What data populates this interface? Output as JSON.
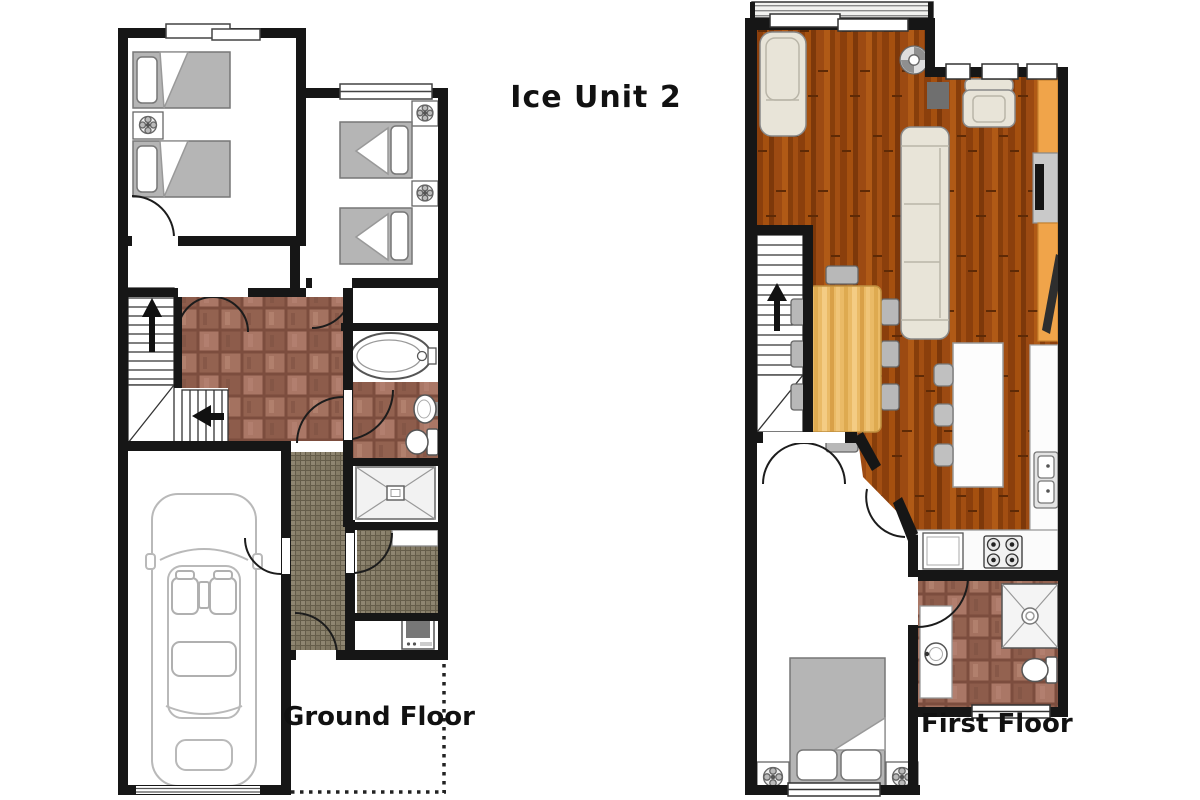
{
  "title": "Ice Unit 2",
  "floors": {
    "ground": {
      "label": "Ground Floor",
      "rooms": [
        "bedroom-1",
        "bedroom-2",
        "bathroom",
        "hallway",
        "stairs",
        "entry-hall",
        "shower-room",
        "utility-room",
        "garage"
      ],
      "features": [
        "twin-bed",
        "twin-bed",
        "twin-bed",
        "twin-bed",
        "nightstand-fan",
        "bathtub",
        "wash-basin",
        "toilet",
        "shower",
        "washing-machine",
        "car"
      ]
    },
    "first": {
      "label": "First Floor",
      "rooms": [
        "balcony",
        "living-room",
        "dining-area",
        "kitchen",
        "stairs",
        "bedroom",
        "bathroom"
      ],
      "features": [
        "chaise-longue",
        "sofa",
        "armchair",
        "tv-unit",
        "ceiling-fan",
        "dining-table",
        "dining-chairs",
        "kitchen-island",
        "bar-stools",
        "double-sink",
        "stove",
        "double-bed",
        "nightstand-fan",
        "shower",
        "toilet",
        "wash-basin"
      ]
    }
  },
  "colors": {
    "wall": "#161616",
    "wood_floor": "#96470f",
    "brick_tile": "#9c6a58",
    "mosaic_tile": "#867d67",
    "table_wood": "#eaba66",
    "counter_orange": "#f0a44a",
    "bed_grey": "#b5b5b5",
    "upholstery_beige": "#e8e4d8"
  }
}
